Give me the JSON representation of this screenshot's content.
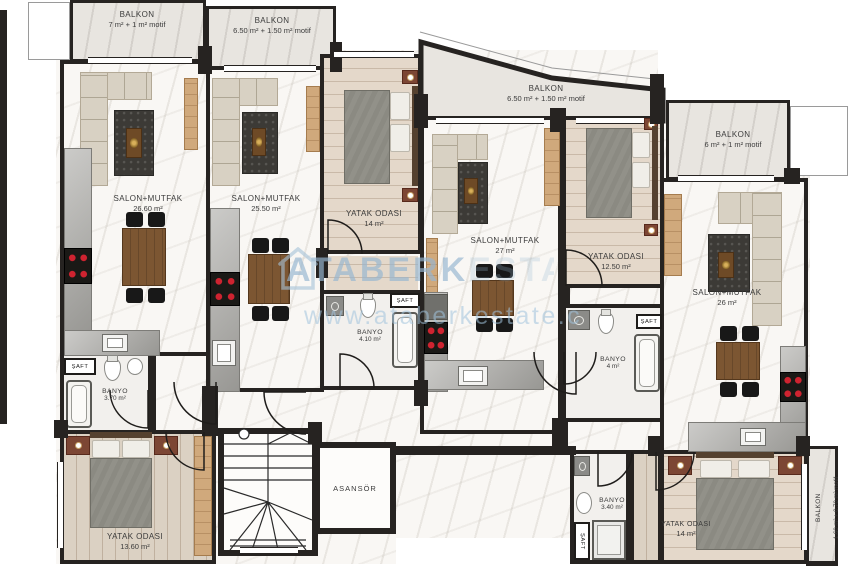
{
  "meta": {
    "drawing_type": "apartment floor plan"
  },
  "watermark": {
    "brand": "ATABERK",
    "suffix": "ESTATE",
    "url": "www.ataberkestate.com"
  },
  "labels": {
    "saft": "ŞAFT",
    "asansor": "ASANSÖR"
  },
  "colors": {
    "wall": "#262321",
    "marble": "#f9f7f4",
    "balcony": "#e8e5e0",
    "wood": "#dbd1c3",
    "accentwood": "#d0a97c",
    "rug": "#3c3a36",
    "sofa": "#d8d1c3",
    "counter": "#a9a8a4",
    "stovered": "#cf2330",
    "watermark_blue": "#a5c2d8"
  },
  "rooms": {
    "balkon1": {
      "name": "BALKON",
      "area": "7 m² + 1 m² motif"
    },
    "balkon2": {
      "name": "BALKON",
      "area": "6.50 m² + 1.50 m² motif"
    },
    "balkon3": {
      "name": "BALKON",
      "area": "6.50 m² + 1.50 m² motif"
    },
    "balkon4": {
      "name": "BALKON",
      "area": "6 m² + 1 m² motif"
    },
    "balkon5": {
      "name": "BALKON",
      "area": "1.60 m² + 0.70 m² motif"
    },
    "salon1": {
      "name": "SALON+MUTFAK",
      "area": "26.60 m²"
    },
    "salon2": {
      "name": "SALON+MUTFAK",
      "area": "25.50 m²"
    },
    "salon3": {
      "name": "SALON+MUTFAK",
      "area": "27 m²"
    },
    "salon4": {
      "name": "SALON+MUTFAK",
      "area": "26 m²"
    },
    "yatak1": {
      "name": "YATAK ODASI",
      "area": "13.60 m²"
    },
    "yatak2": {
      "name": "YATAK ODASI",
      "area": "14 m²"
    },
    "yatak3": {
      "name": "YATAK ODASI",
      "area": "12.50 m²"
    },
    "yatak4": {
      "name": "YATAK ODASI",
      "area": "14 m²"
    },
    "banyo1": {
      "name": "BANYO",
      "area": "3.70 m²"
    },
    "banyo2": {
      "name": "BANYO",
      "area": "4.10 m²"
    },
    "banyo3": {
      "name": "BANYO",
      "area": "4 m²"
    },
    "banyo4": {
      "name": "BANYO",
      "area": "3.40 m²"
    }
  }
}
